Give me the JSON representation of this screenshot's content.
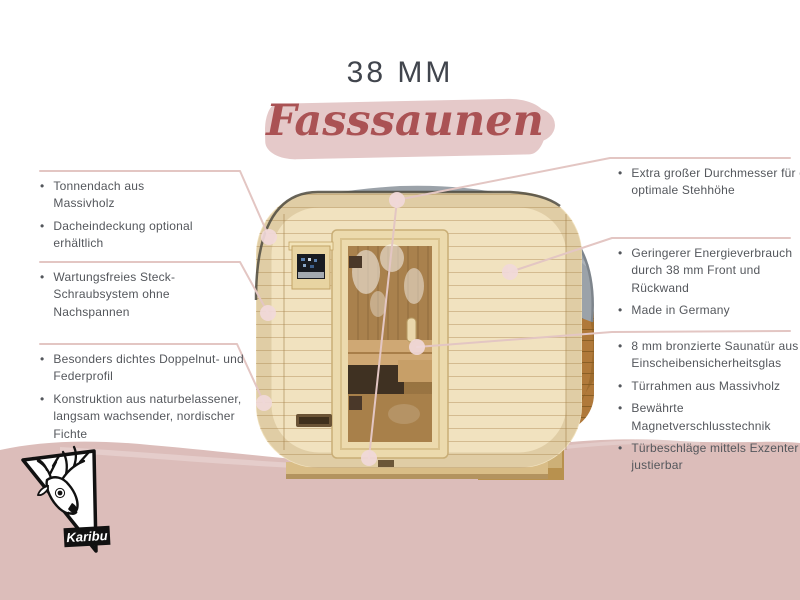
{
  "header": {
    "size_label": "38 MM",
    "product_title": "Fasssaunen"
  },
  "callouts": {
    "left": [
      {
        "items": [
          "Tonnendach aus Massivholz",
          "Dacheindeckung optional erhältlich"
        ]
      },
      {
        "items": [
          "Wartungsfreies Steck-Schraubsystem ohne Nachspannen"
        ]
      },
      {
        "items": [
          "Besonders dichtes Doppelnut- und Federprofil",
          "Konstruktion aus naturbelassener, langsam wachsender, nordischer Fichte"
        ]
      }
    ],
    "right": [
      {
        "items": [
          "Extra großer Durchmesser für eine optimale Stehhöhe"
        ]
      },
      {
        "items": [
          "Geringerer Energieverbrauch durch 38 mm Front und Rückwand",
          "Made in Germany"
        ]
      },
      {
        "items": [
          "8 mm bronzierte Saunatür aus Einscheibensicherheitsglas",
          "Türrahmen aus Massivholz",
          "Bewährte Magnetverschlusstechnik",
          "Türbeschläge mittels Exzenter justierbar"
        ]
      }
    ]
  },
  "logo": {
    "brand": "Karibu"
  },
  "bullet_glyph": "•",
  "colors": {
    "connector_pink": "#e3c6c3",
    "dot_pink": "#f1d9da",
    "brush_pink": "#e5c9c9",
    "wash_pink": "#dcbdba",
    "title_red": "#aa5254",
    "text_gray": "#54575c",
    "heading_gray": "#41454d"
  }
}
